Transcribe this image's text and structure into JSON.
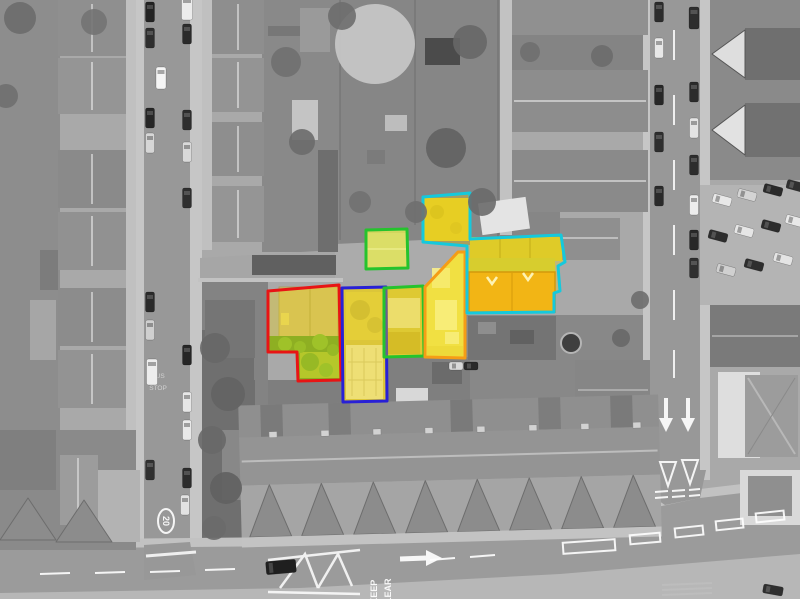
{
  "scene": {
    "width": 800,
    "height": 599,
    "background": "#b2b2b2",
    "road_color": "#989898",
    "sidewalk_color": "#c6c6c6"
  },
  "road_markings": {
    "keep": "KEEP",
    "clear": "CLEAR",
    "speed_limit": "20",
    "bus": "BUS",
    "stop": "STOP"
  },
  "parcels": [
    {
      "id": "parcel-red",
      "outline": "#e81414",
      "fill": "rgba(255,224,0,0.30)",
      "points": "268,291 339,285 341,380 298,381 297,352 268,352"
    },
    {
      "id": "parcel-blue",
      "outline": "#2820d6",
      "fill": "rgba(252,222,10,0.32)",
      "points": "342,288 386,287 387,401 343,402"
    },
    {
      "id": "parcel-green-small",
      "outline": "#25c32d",
      "fill": "rgba(228,232,70,0.40)",
      "points": "366,230 407,229 408,268 366,269"
    },
    {
      "id": "parcel-green-tall",
      "outline": "#25c32d",
      "fill": "rgba(250,222,0,0.32)",
      "points": "384,288 423,286 424,356 384,357"
    },
    {
      "id": "parcel-orange",
      "outline": "#f59d16",
      "fill": "rgba(252,236,50,0.38)",
      "points": "458,252 465,252 465,358 425,357 425,287"
    },
    {
      "id": "parcel-cyan",
      "outline": "#15c9dc",
      "fill": "rgba(248,216,10,0.30)",
      "points": "423,197 470,193 470,239 561,235 565,262 558,266 560,291 554,293 554,312 467,313 467,246 423,242"
    }
  ],
  "cars": [
    {
      "x": 150,
      "y": 12,
      "a": 90,
      "l": 20,
      "w": 9,
      "c": "#232323"
    },
    {
      "x": 150,
      "y": 38,
      "a": 90,
      "l": 20,
      "w": 9,
      "c": "#2e2e2e"
    },
    {
      "x": 150,
      "y": 118,
      "a": 90,
      "l": 20,
      "w": 9,
      "c": "#262626"
    },
    {
      "x": 150,
      "y": 143,
      "a": 90,
      "l": 20,
      "w": 9,
      "c": "#d6d6d6"
    },
    {
      "x": 161,
      "y": 78,
      "a": 90,
      "l": 22,
      "w": 10,
      "c": "#f5f5f5"
    },
    {
      "x": 150,
      "y": 302,
      "a": 90,
      "l": 20,
      "w": 9,
      "c": "#2a2a2a"
    },
    {
      "x": 150,
      "y": 330,
      "a": 90,
      "l": 20,
      "w": 9,
      "c": "#cfcfcf"
    },
    {
      "x": 152,
      "y": 372,
      "a": 90,
      "l": 26,
      "w": 11,
      "c": "#ededed"
    },
    {
      "x": 150,
      "y": 470,
      "a": 90,
      "l": 20,
      "w": 9,
      "c": "#303030"
    },
    {
      "x": 185,
      "y": 505,
      "a": 90,
      "l": 20,
      "w": 9,
      "c": "#e2e2e2"
    },
    {
      "x": 187,
      "y": 8,
      "a": 90,
      "l": 24,
      "w": 11,
      "c": "#ececec"
    },
    {
      "x": 187,
      "y": 34,
      "a": 90,
      "l": 20,
      "w": 9,
      "c": "#2b2b2b"
    },
    {
      "x": 187,
      "y": 120,
      "a": 90,
      "l": 20,
      "w": 9,
      "c": "#2e2e2e"
    },
    {
      "x": 187,
      "y": 152,
      "a": 90,
      "l": 20,
      "w": 9,
      "c": "#d9d9d9"
    },
    {
      "x": 187,
      "y": 198,
      "a": 90,
      "l": 20,
      "w": 9,
      "c": "#2f2f2f"
    },
    {
      "x": 187,
      "y": 355,
      "a": 90,
      "l": 20,
      "w": 9,
      "c": "#262626"
    },
    {
      "x": 187,
      "y": 402,
      "a": 90,
      "l": 20,
      "w": 9,
      "c": "#e6e6e6"
    },
    {
      "x": 187,
      "y": 430,
      "a": 90,
      "l": 20,
      "w": 9,
      "c": "#e9e9e9"
    },
    {
      "x": 187,
      "y": 478,
      "a": 90,
      "l": 20,
      "w": 9,
      "c": "#2c2c2c"
    },
    {
      "x": 659,
      "y": 12,
      "a": 90,
      "l": 20,
      "w": 9,
      "c": "#2c2c2c"
    },
    {
      "x": 659,
      "y": 48,
      "a": 90,
      "l": 20,
      "w": 9,
      "c": "#e8e8e8"
    },
    {
      "x": 659,
      "y": 95,
      "a": 90,
      "l": 20,
      "w": 9,
      "c": "#272727"
    },
    {
      "x": 659,
      "y": 142,
      "a": 90,
      "l": 20,
      "w": 9,
      "c": "#2e2e2e"
    },
    {
      "x": 659,
      "y": 196,
      "a": 90,
      "l": 20,
      "w": 9,
      "c": "#2a2a2a"
    },
    {
      "x": 694,
      "y": 18,
      "a": 90,
      "l": 22,
      "w": 10,
      "c": "#2e2e2e"
    },
    {
      "x": 694,
      "y": 92,
      "a": 90,
      "l": 20,
      "w": 9,
      "c": "#2b2b2b"
    },
    {
      "x": 694,
      "y": 128,
      "a": 90,
      "l": 20,
      "w": 9,
      "c": "#e4e4e4"
    },
    {
      "x": 694,
      "y": 165,
      "a": 90,
      "l": 20,
      "w": 9,
      "c": "#2d2d2d"
    },
    {
      "x": 694,
      "y": 205,
      "a": 90,
      "l": 20,
      "w": 9,
      "c": "#ececec"
    },
    {
      "x": 694,
      "y": 240,
      "a": 90,
      "l": 20,
      "w": 9,
      "c": "#282828"
    },
    {
      "x": 694,
      "y": 268,
      "a": 90,
      "l": 20,
      "w": 9,
      "c": "#2f2f2f"
    },
    {
      "x": 722,
      "y": 200,
      "a": 15,
      "l": 19,
      "w": 9,
      "c": "#e8e8e8"
    },
    {
      "x": 747,
      "y": 195,
      "a": 15,
      "l": 19,
      "w": 9,
      "c": "#d4d4d4"
    },
    {
      "x": 773,
      "y": 190,
      "a": 15,
      "l": 19,
      "w": 9,
      "c": "#2a2a2a"
    },
    {
      "x": 796,
      "y": 186,
      "a": 15,
      "l": 19,
      "w": 9,
      "c": "#303030"
    },
    {
      "x": 718,
      "y": 236,
      "a": 15,
      "l": 19,
      "w": 9,
      "c": "#2d2d2d"
    },
    {
      "x": 744,
      "y": 231,
      "a": 15,
      "l": 19,
      "w": 9,
      "c": "#e6e6e6"
    },
    {
      "x": 771,
      "y": 226,
      "a": 15,
      "l": 19,
      "w": 9,
      "c": "#2c2c2c"
    },
    {
      "x": 795,
      "y": 221,
      "a": 15,
      "l": 19,
      "w": 9,
      "c": "#e9e9e9"
    },
    {
      "x": 726,
      "y": 270,
      "a": 15,
      "l": 19,
      "w": 9,
      "c": "#d0d0d0"
    },
    {
      "x": 754,
      "y": 265,
      "a": 15,
      "l": 19,
      "w": 9,
      "c": "#2e2e2e"
    },
    {
      "x": 783,
      "y": 259,
      "a": 15,
      "l": 19,
      "w": 9,
      "c": "#e4e4e4"
    },
    {
      "x": 456,
      "y": 366,
      "a": 0,
      "l": 14,
      "w": 8,
      "c": "#d9d9d9"
    },
    {
      "x": 471,
      "y": 366,
      "a": 0,
      "l": 14,
      "w": 8,
      "c": "#2b2b2b"
    },
    {
      "x": 281,
      "y": 567,
      "a": -5,
      "l": 30,
      "w": 13,
      "c": "#1f1f1f"
    },
    {
      "x": 773,
      "y": 590,
      "a": 10,
      "l": 20,
      "w": 9,
      "c": "#2f2f2f"
    }
  ],
  "trees": [
    {
      "x": 375,
      "y": 44,
      "r": 40,
      "c": "#c9c9c9"
    },
    {
      "x": 342,
      "y": 16,
      "r": 14,
      "c": "#6e6e6e"
    },
    {
      "x": 470,
      "y": 42,
      "r": 17,
      "c": "#676767"
    },
    {
      "x": 446,
      "y": 148,
      "r": 20,
      "c": "#626262"
    },
    {
      "x": 482,
      "y": 202,
      "r": 14,
      "c": "#6a6a6a"
    },
    {
      "x": 416,
      "y": 212,
      "r": 11,
      "c": "#6f6f6f"
    },
    {
      "x": 286,
      "y": 62,
      "r": 15,
      "c": "#707070"
    },
    {
      "x": 302,
      "y": 142,
      "r": 13,
      "c": "#6b6b6b"
    },
    {
      "x": 360,
      "y": 202,
      "r": 11,
      "c": "#717171"
    },
    {
      "x": 20,
      "y": 18,
      "r": 16,
      "c": "#6b6b6b"
    },
    {
      "x": 94,
      "y": 22,
      "r": 13,
      "c": "#737373"
    },
    {
      "x": 6,
      "y": 96,
      "r": 12,
      "c": "#6f6f6f"
    },
    {
      "x": 215,
      "y": 348,
      "r": 15,
      "c": "#676767"
    },
    {
      "x": 228,
      "y": 394,
      "r": 17,
      "c": "#636363"
    },
    {
      "x": 212,
      "y": 440,
      "r": 14,
      "c": "#686868"
    },
    {
      "x": 226,
      "y": 488,
      "r": 16,
      "c": "#606060"
    },
    {
      "x": 214,
      "y": 528,
      "r": 12,
      "c": "#6a6a6a"
    },
    {
      "x": 530,
      "y": 52,
      "r": 10,
      "c": "#6f6f6f"
    },
    {
      "x": 602,
      "y": 56,
      "r": 11,
      "c": "#6b6b6b"
    },
    {
      "x": 640,
      "y": 300,
      "r": 9,
      "c": "#6d6d6d"
    },
    {
      "x": 621,
      "y": 338,
      "r": 9,
      "c": "#686868"
    }
  ]
}
